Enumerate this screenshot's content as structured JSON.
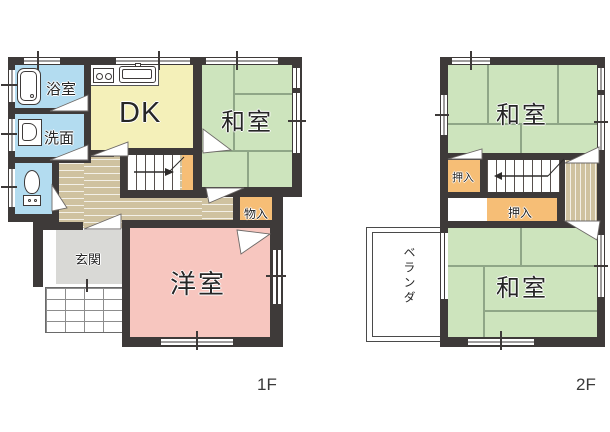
{
  "floor_1f": {
    "floor_label": "1F",
    "rooms": {
      "bath": "浴室",
      "washroom": "洗面",
      "dining_kitchen": "DK",
      "japanese_room": "和室",
      "storage": "物入",
      "entrance": "玄関",
      "western_room": "洋室"
    }
  },
  "floor_2f": {
    "floor_label": "2F",
    "rooms": {
      "japanese_room_north": "和室",
      "closet_upper": "押入",
      "closet_lower": "押入",
      "japanese_room_south": "和室",
      "veranda": "ベランダ"
    }
  },
  "icons": {
    "bathtub": "bathtub-icon",
    "washbasin": "washbasin-icon",
    "toilet": "toilet-icon",
    "stove": "stove-icon",
    "kitchen_sink": "kitchen-sink-icon",
    "stairs_up_arrow": "stairs-direction-arrow"
  },
  "colors": {
    "wall": "#3e3a39",
    "tatami_room": "#cde4bd",
    "dining_kitchen": "#f4f0b9",
    "western_room": "#f7c6bf",
    "closet": "#f6be76",
    "wet_area": "#b3dcf0",
    "hallway": "#cfc2a0",
    "entrance": "#d9d9d6"
  }
}
